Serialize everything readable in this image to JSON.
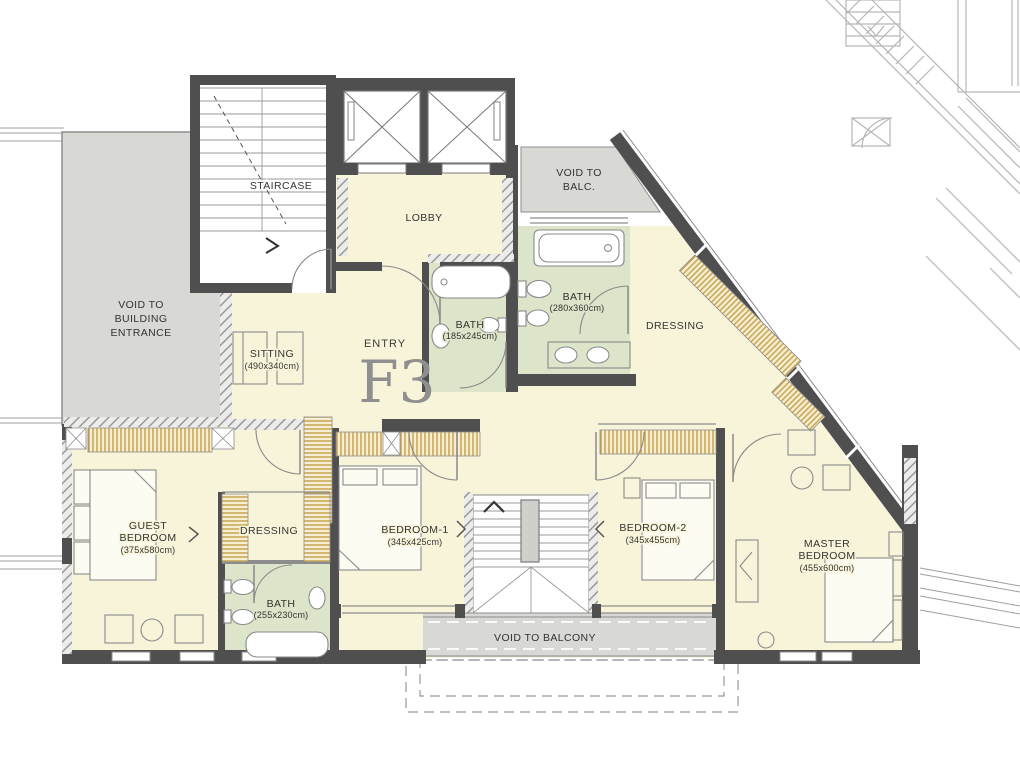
{
  "unit": {
    "label": "F3",
    "entry_label": "ENTRY"
  },
  "rooms": {
    "staircase": {
      "label": "STAIRCASE"
    },
    "lobby": {
      "label": "LOBBY"
    },
    "void_balc": {
      "line1": "VOID TO",
      "line2": "BALC."
    },
    "void_building": {
      "line1": "VOID TO",
      "line2": "BUILDING",
      "line3": "ENTRANCE"
    },
    "sitting": {
      "label": "SITTING",
      "dims": "(490x340cm)"
    },
    "bath_entry": {
      "label": "BATH",
      "dims": "(185x245cm)"
    },
    "bath_master": {
      "label": "BATH",
      "dims": "(280x360cm)"
    },
    "dressing_master": {
      "label": "DRESSING"
    },
    "guest_bedroom": {
      "line1": "GUEST",
      "line2": "BEDROOM",
      "dims": "(375x580cm)"
    },
    "dressing_guest": {
      "label": "DRESSING"
    },
    "bath_guest": {
      "label": "BATH",
      "dims": "(255x230cm)"
    },
    "bedroom1": {
      "label": "BEDROOM-1",
      "dims": "(345x425cm)"
    },
    "bedroom2": {
      "label": "BEDROOM-2",
      "dims": "(345x455cm)"
    },
    "master_bedroom": {
      "line1": "MASTER",
      "line2": "BEDROOM",
      "dims": "(455x600cm)"
    },
    "void_balcony": {
      "label": "VOID TO BALCONY"
    }
  },
  "palette": {
    "wall": "#4f4f4f",
    "room_fill": "#f8f4da",
    "bath_fill": "#dce4c9",
    "void_fill": "#d8d8d4",
    "closet_stripe": "#c49f45",
    "closet_bg": "#f6eed2",
    "outline_gray": "#8d8d8d",
    "adjacent_gray": "#b6b6b6",
    "label_color": "#333333",
    "unit_text": "#8f8f8f"
  }
}
